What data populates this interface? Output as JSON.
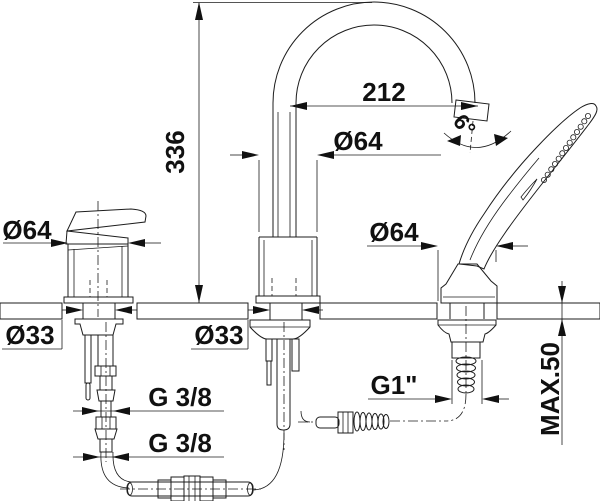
{
  "drawing": {
    "background": "#ffffff",
    "line_color": "#1c1c1c",
    "labels": {
      "height": "336",
      "reach": "212",
      "swivel_angle": "6°",
      "handle_diameter": "Ø64",
      "spout_diameter": "Ø64",
      "shower_diameter": "Ø64",
      "hole_left": "Ø33",
      "hole_center": "Ø33",
      "connection_upper": "G 3/8",
      "connection_lower": "G 3/8",
      "shower_connection": "G1\"",
      "deck_thickness": "MAX.50"
    }
  }
}
